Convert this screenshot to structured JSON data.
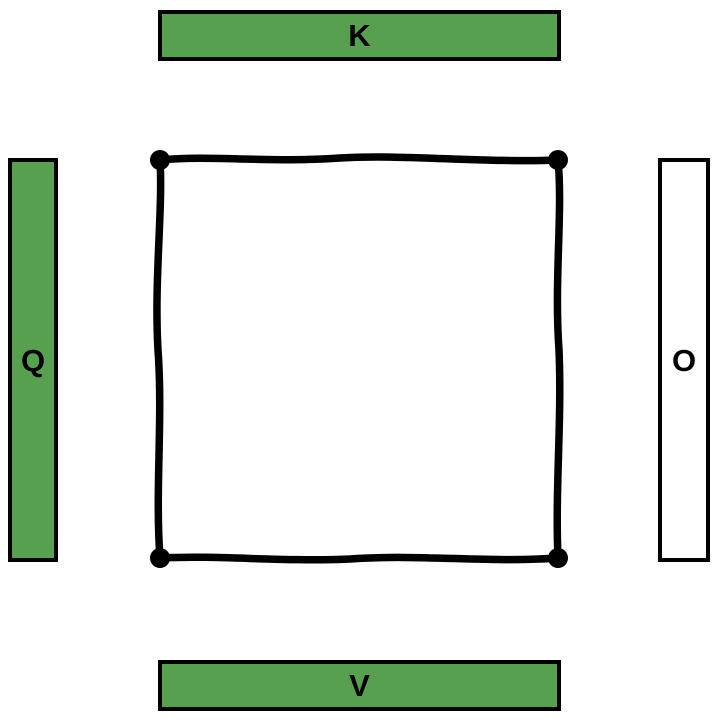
{
  "canvas": {
    "background": "#ffffff",
    "width": 720,
    "height": 720
  },
  "pieces": {
    "top": {
      "label": "K",
      "fill": "#57a050",
      "text_color": "#000000"
    },
    "left": {
      "label": "Q",
      "fill": "#57a050",
      "text_color": "#000000"
    },
    "right": {
      "label": "O",
      "fill": "#ffffff",
      "text_color": "#000000"
    },
    "bottom": {
      "label": "V",
      "fill": "#57a050",
      "text_color": "#000000"
    }
  },
  "drop_zone": {
    "border_color": "#000000"
  }
}
